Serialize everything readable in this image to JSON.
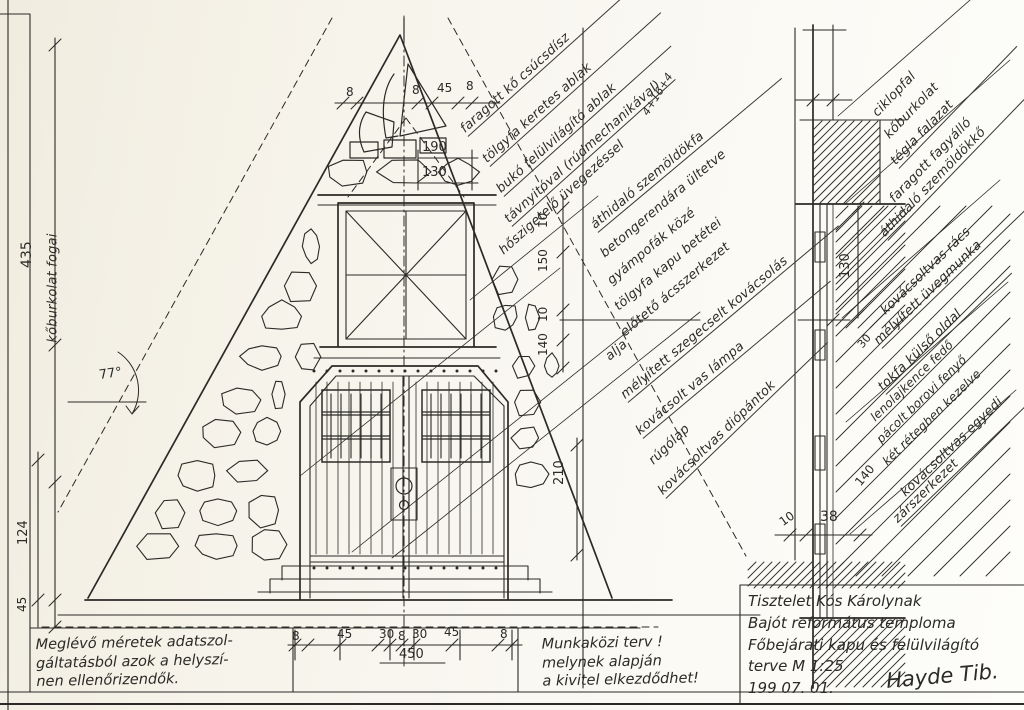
{
  "sheet": {
    "background": "#f6f3ea",
    "ink": "#2b2a26",
    "scale": "M 1:25"
  },
  "annotations": [
    {
      "text": "faragott kő csúcsdísz",
      "x": 468,
      "y": 138,
      "rot": -42,
      "w": 235
    },
    {
      "text": "tölgyfa keretes ablak",
      "x": 490,
      "y": 168,
      "rot": -42,
      "w": 230
    },
    {
      "text": "bukó felülvilágító ablak",
      "x": 504,
      "y": 198,
      "rot": -42,
      "w": 225
    },
    {
      "text": "távnyitóval (rúdmechanikával)",
      "x": 512,
      "y": 228,
      "rot": -42,
      "w": 220
    },
    {
      "text": "hőszigetelő üvegezéssel",
      "x": 506,
      "y": 260,
      "rot": -42,
      "w": 0
    },
    {
      "text": "4+16+4",
      "x": 650,
      "y": 120,
      "rot": -58,
      "w": 0,
      "size": 11
    },
    {
      "text": "áthidaló szemöldökfa",
      "x": 598,
      "y": 234,
      "rot": -40,
      "w": 240
    },
    {
      "text": "betongerendára ültetve",
      "x": 607,
      "y": 263,
      "rot": -40,
      "w": 0
    },
    {
      "text": "gyámpofák közé",
      "x": 614,
      "y": 290,
      "rot": -40,
      "w": 0
    },
    {
      "text": "tölgyfa kapu betétei",
      "x": 621,
      "y": 316,
      "rot": -40,
      "w": 0
    },
    {
      "text": "előtető ácsszerkezet",
      "x": 627,
      "y": 342,
      "rot": -40,
      "w": 0
    },
    {
      "text": "alja",
      "x": 612,
      "y": 366,
      "rot": -40,
      "w": 0
    },
    {
      "text": "mélyített szegecselt kovácsolás",
      "x": 628,
      "y": 404,
      "rot": -40,
      "w": 275
    },
    {
      "text": "kovácsolt vas lámpa",
      "x": 643,
      "y": 440,
      "rot": -40,
      "w": 245
    },
    {
      "text": "rúgólap",
      "x": 656,
      "y": 470,
      "rot": -44,
      "w": 0
    },
    {
      "text": "kovácsoltvas diópántok",
      "x": 666,
      "y": 500,
      "rot": -44,
      "w": 225
    },
    {
      "text": "ciklopfal",
      "x": 880,
      "y": 122,
      "rot": -46,
      "w": 0
    },
    {
      "text": "kőburkolat",
      "x": 892,
      "y": 144,
      "rot": -46,
      "w": 0
    },
    {
      "text": "tégla falazat",
      "x": 899,
      "y": 170,
      "rot": -46,
      "w": 170
    },
    {
      "text": "faragott fagyálló",
      "x": 897,
      "y": 208,
      "rot": -46,
      "w": 0
    },
    {
      "text": "áthidaló szemöldökkő",
      "x": 888,
      "y": 242,
      "rot": -46,
      "w": 220
    },
    {
      "text": "kovácsoltvas rács",
      "x": 888,
      "y": 320,
      "rot": -44,
      "w": 0
    },
    {
      "text": "mélyített üvegmunka",
      "x": 882,
      "y": 350,
      "rot": -44,
      "w": 205
    },
    {
      "text": "tokfa külső oldal",
      "x": 886,
      "y": 396,
      "rot": -44,
      "w": 175
    },
    {
      "text": "lenolajkence fedő",
      "x": 877,
      "y": 426,
      "rot": -44,
      "w": 0,
      "size": 12
    },
    {
      "text": "pácolt borovi fenyő",
      "x": 883,
      "y": 448,
      "rot": -44,
      "w": 0,
      "size": 12
    },
    {
      "text": "két rétegben kezelve",
      "x": 889,
      "y": 470,
      "rot": -44,
      "w": 0,
      "size": 12
    },
    {
      "text": "kovácsoltvas egyedi",
      "x": 908,
      "y": 502,
      "rot": -44,
      "w": 0
    },
    {
      "text": "zárszerkezet",
      "x": 901,
      "y": 528,
      "rot": -44,
      "w": 195
    },
    {
      "text": "kőburkolat fogai",
      "x": 60,
      "y": 345,
      "rot": -90,
      "w": 0,
      "size": 13
    }
  ],
  "dimensions": [
    {
      "text": "435",
      "x": 34,
      "y": 268,
      "rot": -90,
      "size": 14
    },
    {
      "text": "77°",
      "x": 100,
      "y": 382,
      "rot": -8,
      "size": 13
    },
    {
      "text": "124",
      "x": 30,
      "y": 545,
      "rot": -90,
      "size": 13
    },
    {
      "text": "45",
      "x": 28,
      "y": 612,
      "rot": -90,
      "size": 12
    },
    {
      "text": "8",
      "x": 346,
      "y": 98,
      "rot": 0,
      "size": 12
    },
    {
      "text": "8",
      "x": 412,
      "y": 96,
      "rot": 0,
      "size": 12
    },
    {
      "text": "45",
      "x": 437,
      "y": 94,
      "rot": 0,
      "size": 12
    },
    {
      "text": "8",
      "x": 466,
      "y": 92,
      "rot": 0,
      "size": 12
    },
    {
      "text": "190",
      "x": 422,
      "y": 154,
      "rot": 0,
      "size": 13
    },
    {
      "text": "130",
      "x": 422,
      "y": 179,
      "rot": 0,
      "size": 13
    },
    {
      "text": "10",
      "x": 549,
      "y": 228,
      "rot": -90,
      "size": 12
    },
    {
      "text": "150",
      "x": 549,
      "y": 272,
      "rot": -90,
      "size": 12
    },
    {
      "text": "10",
      "x": 549,
      "y": 322,
      "rot": -90,
      "size": 12
    },
    {
      "text": "140",
      "x": 549,
      "y": 356,
      "rot": -90,
      "size": 12
    },
    {
      "text": "210",
      "x": 566,
      "y": 485,
      "rot": -90,
      "size": 13
    },
    {
      "text": "8",
      "x": 292,
      "y": 642,
      "rot": 0,
      "size": 12
    },
    {
      "text": "45",
      "x": 337,
      "y": 640,
      "rot": 0,
      "size": 12
    },
    {
      "text": "30",
      "x": 379,
      "y": 640,
      "rot": 0,
      "size": 12
    },
    {
      "text": "8",
      "x": 398,
      "y": 642,
      "rot": 0,
      "size": 12
    },
    {
      "text": "30",
      "x": 412,
      "y": 640,
      "rot": 0,
      "size": 12
    },
    {
      "text": "45",
      "x": 444,
      "y": 638,
      "rot": 0,
      "size": 12
    },
    {
      "text": "8",
      "x": 500,
      "y": 640,
      "rot": 0,
      "size": 12
    },
    {
      "text": "450",
      "x": 399,
      "y": 661,
      "rot": 0,
      "size": 13
    },
    {
      "text": "10",
      "x": 784,
      "y": 528,
      "rot": -35,
      "size": 12
    },
    {
      "text": "38",
      "x": 820,
      "y": 524,
      "rot": 0,
      "size": 14
    },
    {
      "text": "130",
      "x": 852,
      "y": 278,
      "rot": -90,
      "size": 13
    },
    {
      "text": "140",
      "x": 862,
      "y": 488,
      "rot": -50,
      "size": 12
    },
    {
      "text": "30",
      "x": 864,
      "y": 350,
      "rot": -50,
      "size": 11
    }
  ],
  "notes": {
    "left_lines": [
      "Meglévő méretek adatszol-",
      "gáltatásból azok a helyszí-",
      "nen ellenőrizendők."
    ],
    "middle_lines": [
      "Munkaközi terv !",
      "melynek alapján",
      "a kivitel elkezdődhet!"
    ]
  },
  "title_block": {
    "lines": [
      "Tisztelet Kós Károlynak",
      "Bajót református temploma",
      "Főbejárati kapu és felülvilágító",
      "terve  M 1:25",
      "199 07. 01."
    ],
    "signature": "Hayde Tib."
  }
}
